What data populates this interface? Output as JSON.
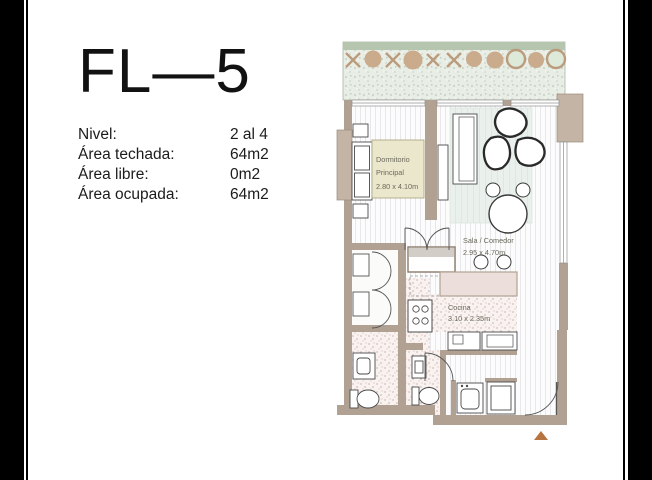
{
  "document": {
    "unit_title": "FL—5",
    "details": [
      {
        "label": "Nivel:",
        "value": "2 al 4"
      },
      {
        "label": "Área techada:",
        "value": "64m2"
      },
      {
        "label": "Área libre:",
        "value": "0m2"
      },
      {
        "label": "Área ocupada:",
        "value": "64m2"
      }
    ]
  },
  "floorplan": {
    "rooms": {
      "bedroom": {
        "name_line1": "Dormitorio",
        "name_line2": "Principal",
        "dimensions": "2.80 x 4.10m"
      },
      "living": {
        "name": "Sala / Comedor",
        "dimensions": "2.95 x 4.70m"
      },
      "kitchen": {
        "name": "Cocina",
        "dimensions": "3.10 x 2.35m"
      }
    },
    "colors": {
      "wall_tan": "#b1a192",
      "pilaster_tan": "#c3b4a6",
      "room_label_bg": "#ebe7cc",
      "hedge_green": "#b6c5ae",
      "terrace_green": "#e8ede6",
      "plant_tan": "#c8a384",
      "tile_pink": "#dcc0ba",
      "rug_green": "#eaf1ec",
      "entrance_marker": "#b57440"
    }
  }
}
